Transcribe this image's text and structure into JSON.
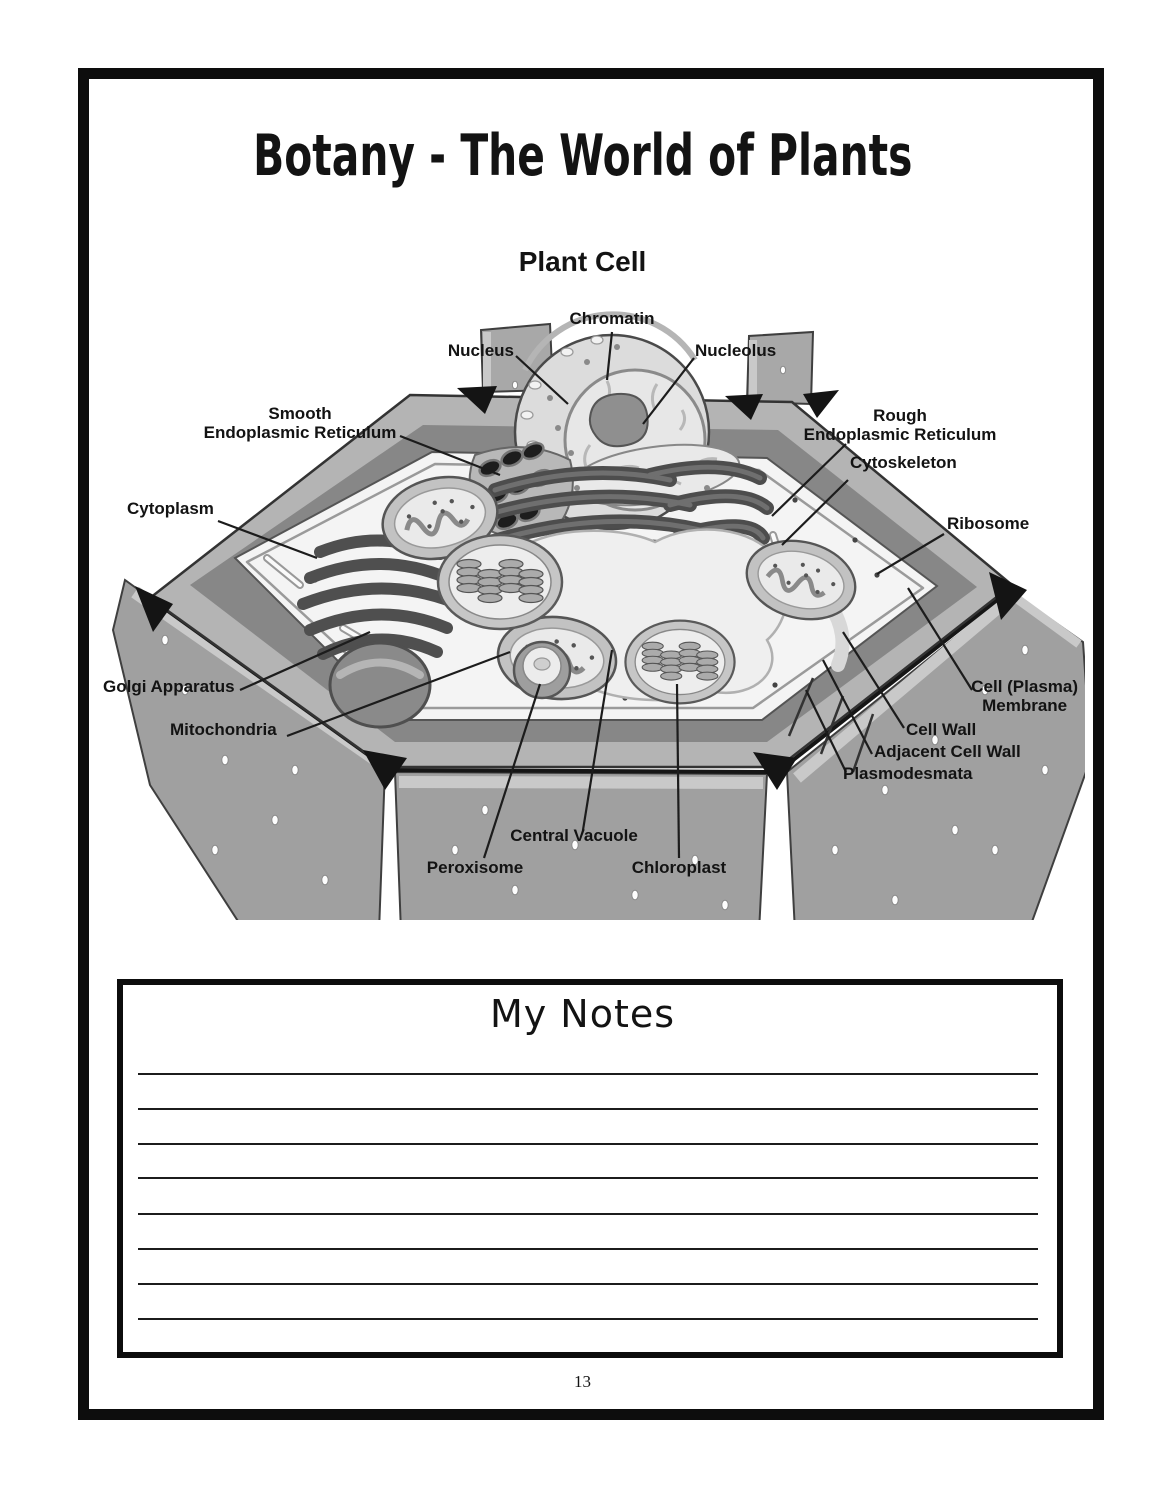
{
  "page": {
    "title": "Botany - The World of Plants",
    "number": "13"
  },
  "diagram": {
    "title": "Plant Cell",
    "labels": [
      {
        "id": "chromatin",
        "text": "Chromatin"
      },
      {
        "id": "nucleus",
        "text": "Nucleus"
      },
      {
        "id": "nucleolus",
        "text": "Nucleolus"
      },
      {
        "id": "smooth-endoplasmic-reticulum",
        "text": "Smooth\nEndoplasmic Reticulum"
      },
      {
        "id": "rough-endoplasmic-reticulum",
        "text": "Rough\nEndoplasmic Reticulum"
      },
      {
        "id": "cytoskeleton",
        "text": "Cytoskeleton"
      },
      {
        "id": "cytoplasm",
        "text": "Cytoplasm"
      },
      {
        "id": "ribosome",
        "text": "Ribosome"
      },
      {
        "id": "golgi-apparatus",
        "text": "Golgi Apparatus"
      },
      {
        "id": "mitochondria",
        "text": "Mitochondria"
      },
      {
        "id": "cell-plasma-membrane",
        "text": "Cell (Plasma)\nMembrane"
      },
      {
        "id": "cell-wall",
        "text": "Cell Wall"
      },
      {
        "id": "adjacent-cell-wall",
        "text": "Adjacent Cell Wall"
      },
      {
        "id": "plasmodesmata",
        "text": "Plasmodesmata"
      },
      {
        "id": "central-vacuole",
        "text": "Central Vacuole"
      },
      {
        "id": "peroxisome",
        "text": "Peroxisome"
      },
      {
        "id": "chloroplast",
        "text": "Chloroplast"
      }
    ]
  },
  "notes": {
    "title": "My Notes"
  },
  "colors": {
    "ink": "#111111",
    "wall_gray": "#a0a0a0",
    "light_band": "#c8c8c8",
    "cytoplasm_fill": "#f4f4f4"
  }
}
